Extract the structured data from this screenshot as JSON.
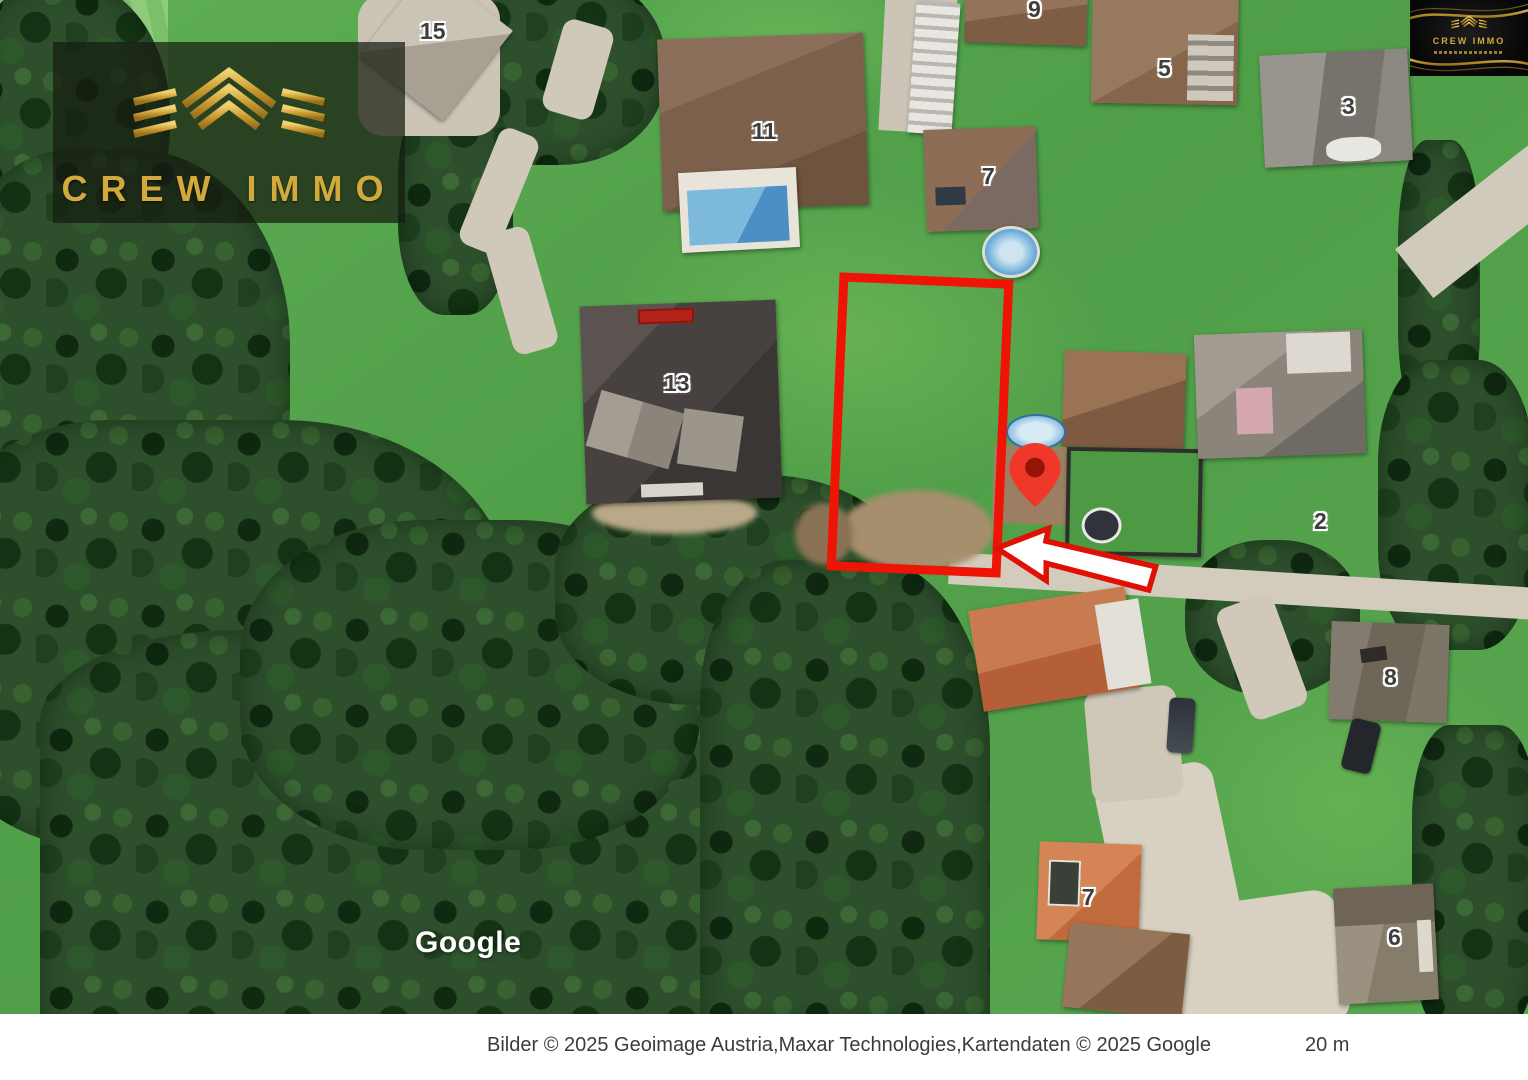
{
  "branding": {
    "logo_text": "CREW IMMO",
    "badge_text": "CREW IMMO"
  },
  "map": {
    "watermark": "Google",
    "house_labels": [
      {
        "id": "15",
        "text": "15"
      },
      {
        "id": "11",
        "text": "11"
      },
      {
        "id": "9",
        "text": "9"
      },
      {
        "id": "7-top",
        "text": "7"
      },
      {
        "id": "5",
        "text": "5"
      },
      {
        "id": "3",
        "text": "3"
      },
      {
        "id": "13",
        "text": "13"
      },
      {
        "id": "2",
        "text": "2"
      },
      {
        "id": "8",
        "text": "8"
      },
      {
        "id": "7-bottom",
        "text": "7"
      },
      {
        "id": "6",
        "text": "6"
      }
    ],
    "overlays": {
      "parcel_outline_color": "#ee1506",
      "pin_color": "#ef382a",
      "arrow_fill": "#ffffff",
      "arrow_outline": "#e01005"
    }
  },
  "attribution": {
    "imagery_text": "Bilder © 2025 Geoimage Austria,Maxar Technologies,Kartendaten © 2025 Google",
    "scale_label": "20 m"
  },
  "colors": {
    "gold": "#d2a93c",
    "grass": "#54a44c",
    "forest": "#2d4f2c"
  }
}
